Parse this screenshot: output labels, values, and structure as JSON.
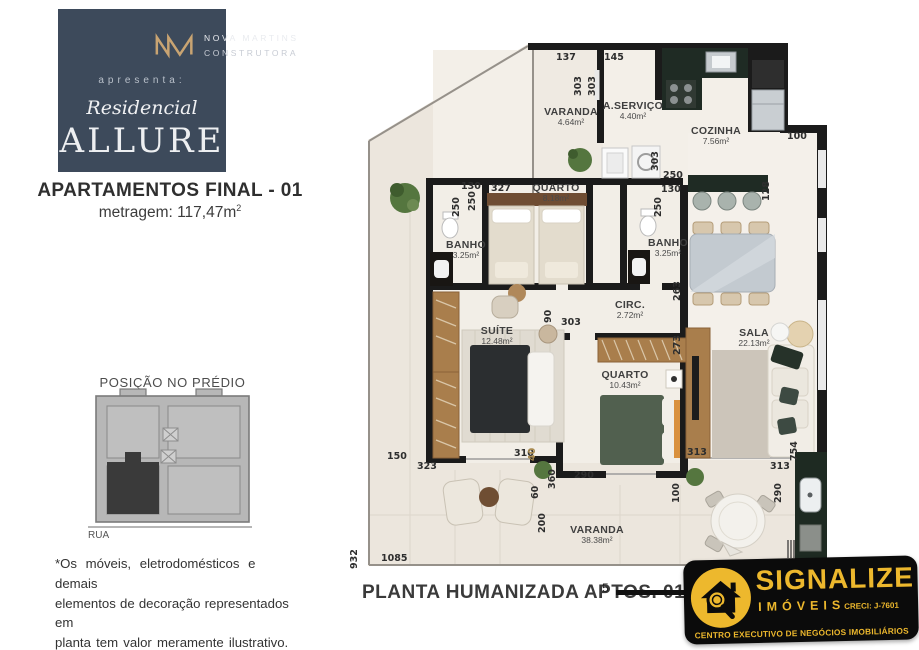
{
  "brand_panel": {
    "bg_color": "#3d4a5b",
    "gold_color": "#c9a472",
    "company_line1": "NOVA MARTINS",
    "company_line2": "CONSTRUTORA",
    "presents": "apresenta:",
    "residence_script": "Residencial",
    "residence_name": "ALLURE"
  },
  "headline": {
    "title": "APARTAMENTOS FINAL - 01",
    "area_value": "metragem: 117,47m",
    "area_sup": "2"
  },
  "position_diagram": {
    "title": "POSIÇÃO NO PRÉDIO",
    "street_label": "RUA",
    "highlight_color": "#3a3a3a",
    "building_color": "#b7b7b7"
  },
  "disclaimer": {
    "line1": "*Os móveis, eletrodomésticos e demais",
    "line2": "elementos de decoração representados em",
    "line3": "planta tem valor meramente ilustrativo."
  },
  "floorplan": {
    "caption": "PLANTA HUMANIZADA APTOS. 01",
    "scale_number": "5",
    "wall_color": "#1b1b1b",
    "floor_color": "#f2eee7",
    "rooms": [
      {
        "id": "varanda-top",
        "name": "VARANDA",
        "area": "4.64m²",
        "x": 571,
        "y": 106
      },
      {
        "id": "aservico",
        "name": "A.SERVIÇO",
        "area": "4.40m²",
        "x": 633,
        "y": 100
      },
      {
        "id": "cozinha",
        "name": "COZINHA",
        "area": "7.56m²",
        "x": 716,
        "y": 125
      },
      {
        "id": "quarto-1",
        "name": "QUARTO",
        "area": "8.18m²",
        "x": 556,
        "y": 182
      },
      {
        "id": "banho-1",
        "name": "BANHO",
        "area": "3.25m²",
        "x": 466,
        "y": 239
      },
      {
        "id": "banho-2",
        "name": "BANHO",
        "area": "3.25m²",
        "x": 668,
        "y": 237
      },
      {
        "id": "circ",
        "name": "CIRC.",
        "area": "2.72m²",
        "x": 630,
        "y": 299
      },
      {
        "id": "suite",
        "name": "SUÍTE",
        "area": "12.48m²",
        "x": 497,
        "y": 325
      },
      {
        "id": "quarto-2",
        "name": "QUARTO",
        "area": "10.43m²",
        "x": 625,
        "y": 369
      },
      {
        "id": "sala",
        "name": "SALA",
        "area": "22.13m²",
        "x": 754,
        "y": 327
      },
      {
        "id": "varanda-main",
        "name": "VARANDA",
        "area": "38.38m²",
        "x": 597,
        "y": 524
      }
    ],
    "dimensions": [
      {
        "v": "137",
        "x": 556,
        "y": 52,
        "o": "h"
      },
      {
        "v": "145",
        "x": 604,
        "y": 52,
        "o": "h"
      },
      {
        "v": "303",
        "x": 584,
        "y": 85,
        "o": "v"
      },
      {
        "v": "303",
        "x": 598,
        "y": 85,
        "o": "v"
      },
      {
        "v": "100",
        "x": 787,
        "y": 131,
        "o": "h"
      },
      {
        "v": "128",
        "x": 772,
        "y": 190,
        "o": "v"
      },
      {
        "v": "303",
        "x": 661,
        "y": 160,
        "o": "v"
      },
      {
        "v": "250",
        "x": 663,
        "y": 170,
        "o": "h"
      },
      {
        "v": "130",
        "x": 661,
        "y": 184,
        "o": "h"
      },
      {
        "v": "250",
        "x": 664,
        "y": 206,
        "o": "v"
      },
      {
        "v": "130",
        "x": 461,
        "y": 181,
        "o": "h"
      },
      {
        "v": "250",
        "x": 462,
        "y": 206,
        "o": "v"
      },
      {
        "v": "250",
        "x": 478,
        "y": 200,
        "o": "v"
      },
      {
        "v": "327",
        "x": 491,
        "y": 183,
        "o": "h"
      },
      {
        "v": "263",
        "x": 683,
        "y": 290,
        "o": "v"
      },
      {
        "v": "273",
        "x": 683,
        "y": 344,
        "o": "v"
      },
      {
        "v": "90",
        "x": 554,
        "y": 312,
        "o": "v"
      },
      {
        "v": "303",
        "x": 561,
        "y": 317,
        "o": "h"
      },
      {
        "v": "150",
        "x": 387,
        "y": 451,
        "o": "h"
      },
      {
        "v": "323",
        "x": 417,
        "y": 461,
        "o": "h"
      },
      {
        "v": "310",
        "x": 514,
        "y": 448,
        "o": "h"
      },
      {
        "v": "40",
        "x": 538,
        "y": 450,
        "o": "v",
        "gold": true
      },
      {
        "v": "360",
        "x": 558,
        "y": 478,
        "o": "v"
      },
      {
        "v": "290",
        "x": 574,
        "y": 470,
        "o": "h"
      },
      {
        "v": "60",
        "x": 541,
        "y": 488,
        "o": "v"
      },
      {
        "v": "200",
        "x": 548,
        "y": 522,
        "o": "v"
      },
      {
        "v": "313",
        "x": 687,
        "y": 447,
        "o": "h"
      },
      {
        "v": "313",
        "x": 770,
        "y": 461,
        "o": "h"
      },
      {
        "v": "290",
        "x": 784,
        "y": 492,
        "o": "v"
      },
      {
        "v": "100",
        "x": 682,
        "y": 492,
        "o": "v"
      },
      {
        "v": "754",
        "x": 800,
        "y": 450,
        "o": "v"
      },
      {
        "v": "932",
        "x": 360,
        "y": 558,
        "o": "v"
      },
      {
        "v": "1085",
        "x": 381,
        "y": 553,
        "o": "h"
      }
    ]
  },
  "agency": {
    "name": "SIGNALIZE",
    "type": "IMÓVEIS",
    "creci": "CRECI: J-7601",
    "tagline": "CENTRO EXECUTIVO DE NEGÓCIOS IMOBILIÁRIOS",
    "gold": "#edb82d",
    "black": "#0b0b0b"
  }
}
